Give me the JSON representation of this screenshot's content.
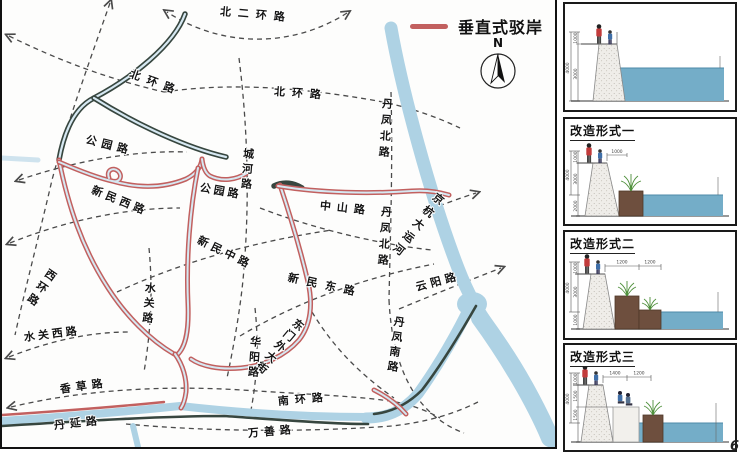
{
  "page_number": "6",
  "legend": {
    "label": "垂直式驳岸",
    "line_color": "#c2605f"
  },
  "compass": {
    "north_label": "N"
  },
  "map": {
    "water_color": "#aed2e4",
    "revetment_vertical_color": "#c2605f",
    "revetment_dark_color": "#37463f",
    "road_labels": [
      {
        "t": "北二环路",
        "x": 218,
        "y": 6,
        "r": 5,
        "v": 0,
        "s": 7
      },
      {
        "t": "北环路",
        "x": 128,
        "y": 68,
        "r": 20,
        "v": 0,
        "s": 7
      },
      {
        "t": "北环路",
        "x": 272,
        "y": 86,
        "r": 4,
        "v": 0,
        "s": 7
      },
      {
        "t": "公园路",
        "x": 84,
        "y": 134,
        "r": 14,
        "v": 0,
        "s": 5
      },
      {
        "t": "城河路",
        "x": 241,
        "y": 148,
        "r": 4,
        "v": 1,
        "s": 4
      },
      {
        "t": "公园路",
        "x": 198,
        "y": 182,
        "r": 10,
        "v": 0,
        "s": 3
      },
      {
        "t": "新民西路",
        "x": 90,
        "y": 184,
        "r": 22,
        "v": 0,
        "s": 4
      },
      {
        "t": "中山路",
        "x": 318,
        "y": 200,
        "r": 6,
        "v": 0,
        "s": 6
      },
      {
        "t": "丹凤北路",
        "x": 380,
        "y": 98,
        "r": 4,
        "v": 1,
        "s": 5
      },
      {
        "t": "丹凤北路",
        "x": 379,
        "y": 206,
        "r": 4,
        "v": 1,
        "s": 5
      },
      {
        "t": "京杭大运河",
        "x": 434,
        "y": 194,
        "r": 38,
        "v": 1,
        "s": 5
      },
      {
        "t": "云阳路",
        "x": 414,
        "y": 282,
        "r": -15,
        "v": 0,
        "s": 4
      },
      {
        "t": "丹凤南路",
        "x": 392,
        "y": 316,
        "r": 8,
        "v": 1,
        "s": 4
      },
      {
        "t": "新民中路",
        "x": 196,
        "y": 234,
        "r": 26,
        "v": 0,
        "s": 4
      },
      {
        "t": "新民东路",
        "x": 286,
        "y": 272,
        "r": 12,
        "v": 0,
        "s": 8
      },
      {
        "t": "东门外大街",
        "x": 294,
        "y": 320,
        "r": 40,
        "v": 1,
        "s": 3
      },
      {
        "t": "西环路",
        "x": 46,
        "y": 270,
        "r": 35,
        "v": 1,
        "s": 4
      },
      {
        "t": "水关路",
        "x": 143,
        "y": 282,
        "r": 5,
        "v": 1,
        "s": 4
      },
      {
        "t": "水关西路",
        "x": 22,
        "y": 332,
        "r": -7,
        "v": 0,
        "s": 3
      },
      {
        "t": "华阳路",
        "x": 248,
        "y": 336,
        "r": 4,
        "v": 1,
        "s": 4
      },
      {
        "t": "南环路",
        "x": 276,
        "y": 396,
        "r": -5,
        "v": 0,
        "s": 6
      },
      {
        "t": "香草路",
        "x": 58,
        "y": 384,
        "r": -8,
        "v": 0,
        "s": 5
      },
      {
        "t": "丹延路",
        "x": 52,
        "y": 420,
        "r": -6,
        "v": 0,
        "s": 5
      },
      {
        "t": "万善路",
        "x": 246,
        "y": 428,
        "r": -5,
        "v": 0,
        "s": 5
      }
    ]
  },
  "sections": [
    {
      "title": "",
      "dims_vertical": [
        "1000",
        "3000"
      ],
      "dim_total": "4000",
      "dims_horizontal": []
    },
    {
      "title": "改造形式一",
      "dims_vertical": [
        "1000",
        "3000",
        "2000"
      ],
      "dim_total": "4000",
      "dims_horizontal": [
        "1000"
      ]
    },
    {
      "title": "改造形式二",
      "dims_vertical": [
        "1000",
        "3000",
        "1000"
      ],
      "dim_total": "4000",
      "dims_horizontal": [
        "1200",
        "1200"
      ]
    },
    {
      "title": "改造形式三",
      "dims_vertical": [
        "1000",
        "1500",
        "1500"
      ],
      "dim_total": "4000",
      "dims_horizontal": [
        "1400",
        "1200"
      ]
    }
  ]
}
